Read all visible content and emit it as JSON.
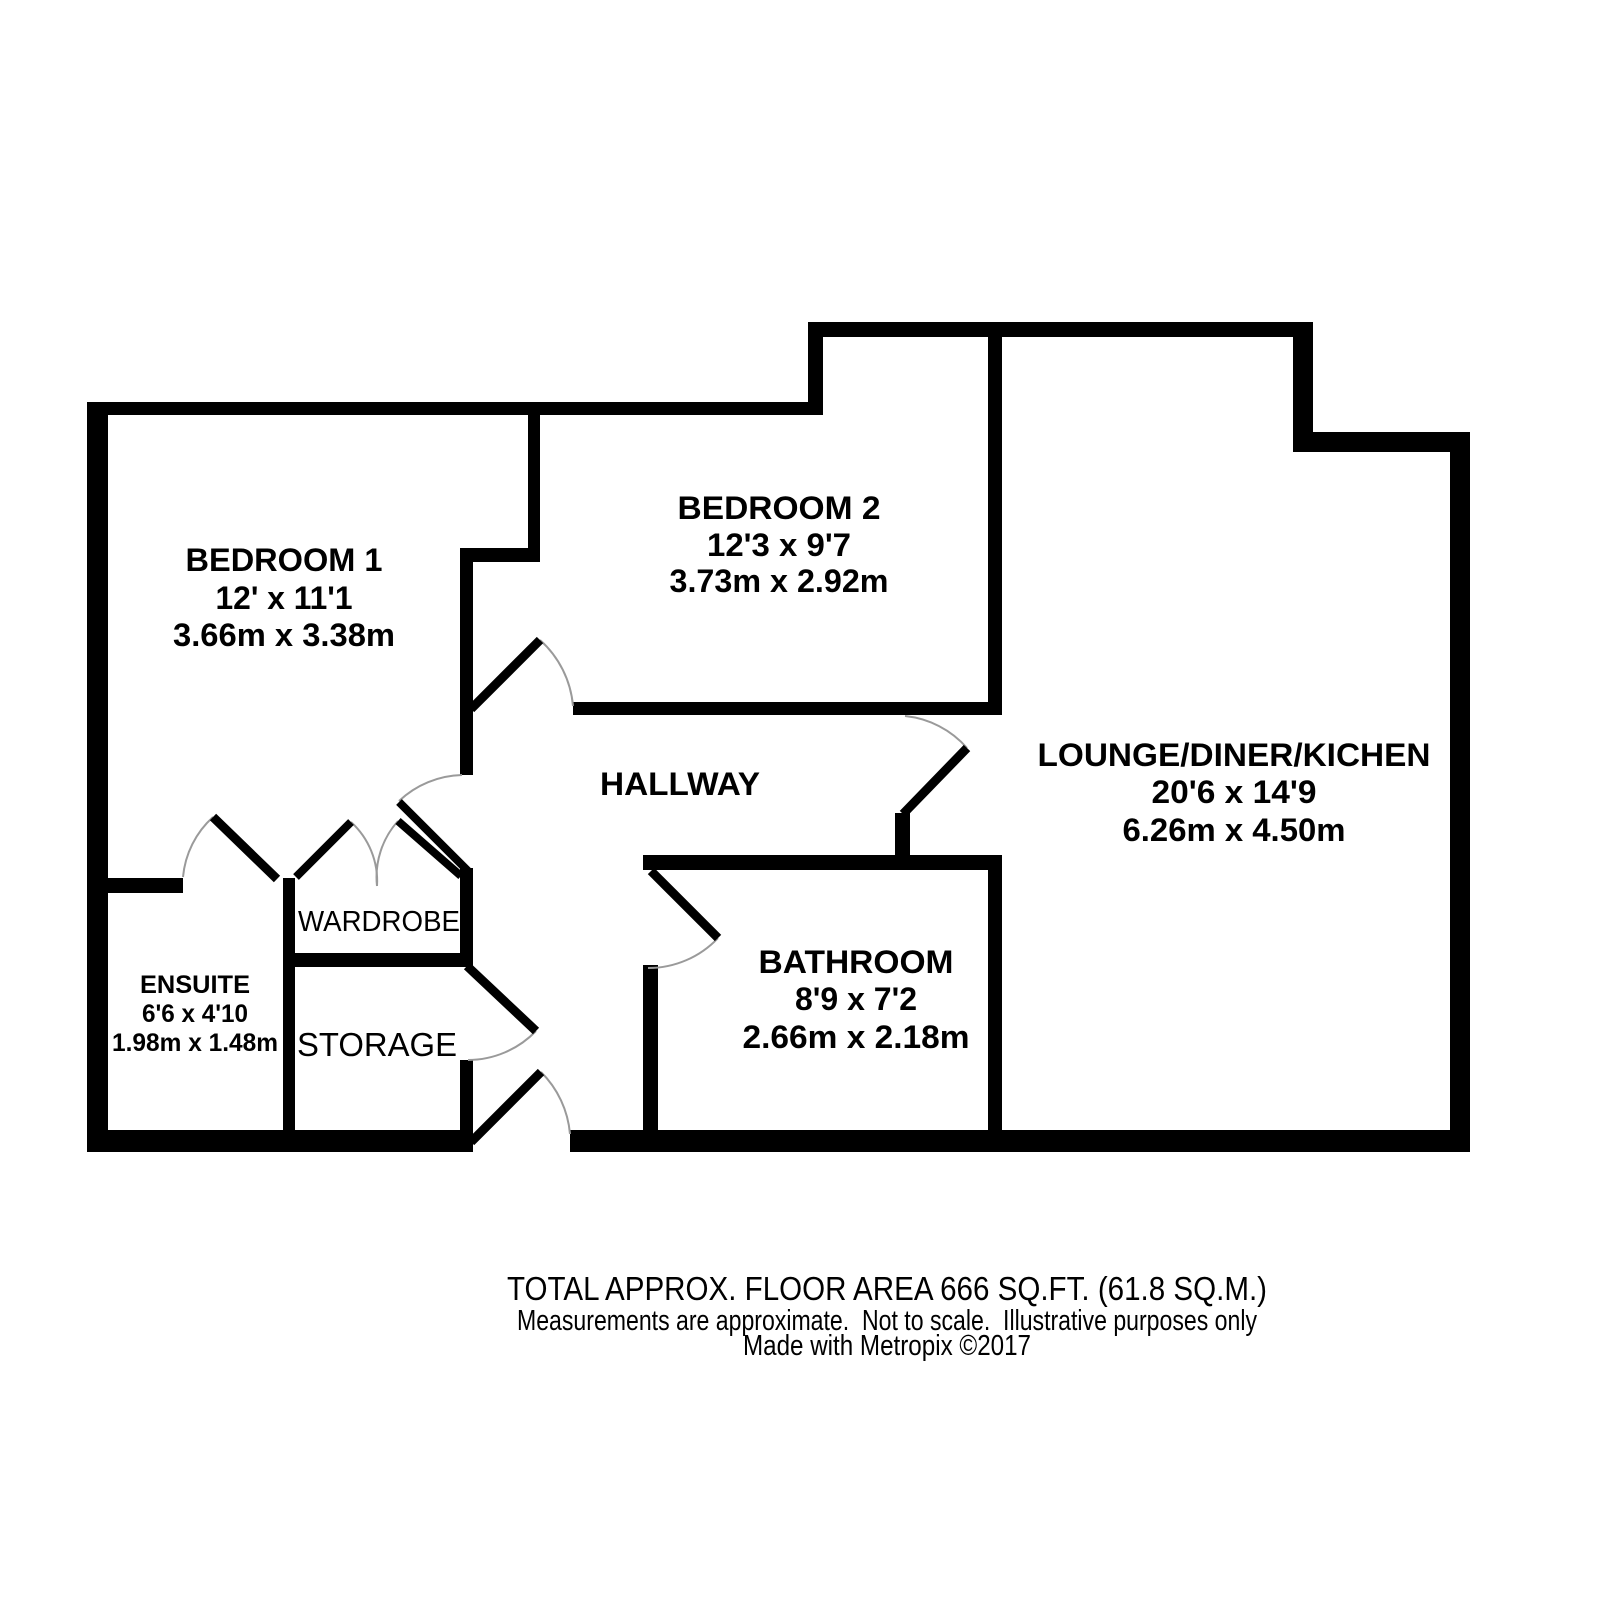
{
  "floorplan": {
    "rooms": [
      {
        "id": "bedroom1",
        "name": "BEDROOM 1",
        "size_imperial": "12' x 11'1",
        "size_metric": "3.66m x 3.38m"
      },
      {
        "id": "bedroom2",
        "name": "BEDROOM 2",
        "size_imperial": "12'3 x 9'7",
        "size_metric": "3.73m x 2.92m"
      },
      {
        "id": "lounge",
        "name": "LOUNGE/DINER/KICHEN",
        "size_imperial": "20'6 x 14'9",
        "size_metric": "6.26m x 4.50m"
      },
      {
        "id": "hallway",
        "name": "HALLWAY"
      },
      {
        "id": "bathroom",
        "name": "BATHROOM",
        "size_imperial": "8'9 x 7'2",
        "size_metric": "2.66m x 2.18m"
      },
      {
        "id": "ensuite",
        "name": "ENSUITE",
        "size_imperial": "6'6 x 4'10",
        "size_metric": "1.98m x 1.48m"
      },
      {
        "id": "wardrobe",
        "name": "WARDROBE"
      },
      {
        "id": "storage",
        "name": "STORAGE"
      }
    ],
    "footer": {
      "total_area": "TOTAL APPROX. FLOOR AREA 666 SQ.FT. (61.8 SQ.M.)",
      "disclaimer": "Measurements are approximate.  Not to scale.  Illustrative purposes only",
      "credit": "Made with Metropix ©2017"
    },
    "colors": {
      "wall": "#000000",
      "text": "#000000",
      "door_arc": "#9a9a9a",
      "background": "#ffffff"
    }
  }
}
